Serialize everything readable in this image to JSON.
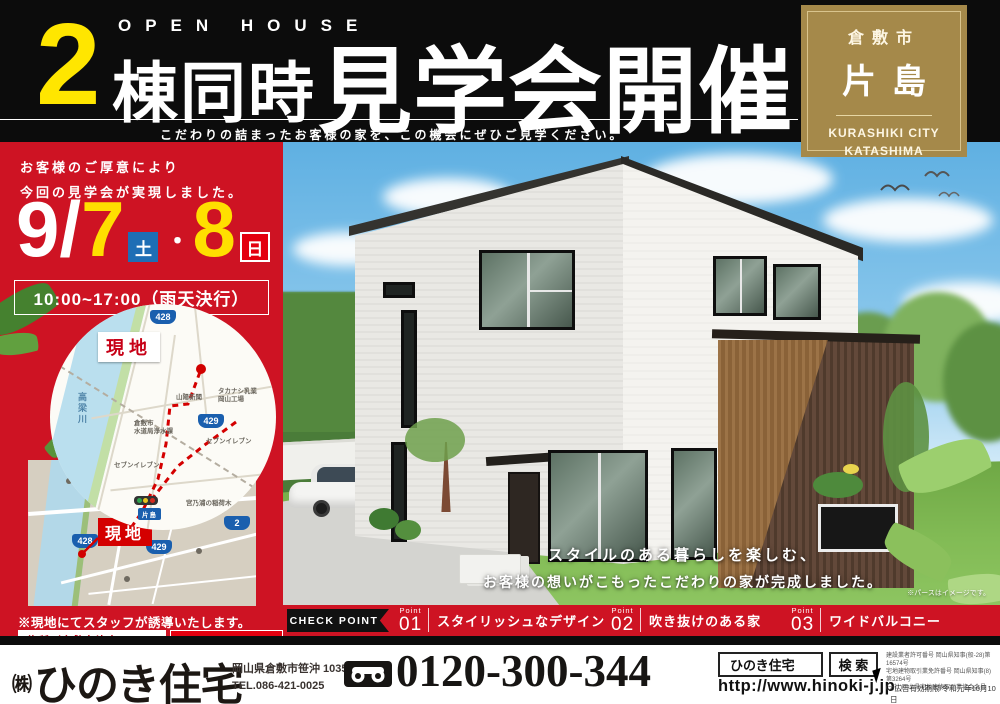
{
  "colors": {
    "accent_red": "#ce1323",
    "badge_brown": "#a5894a",
    "highlight_yellow": "#ffe600",
    "header_black": "#0c0c0c",
    "shield_blue": "#1a5fae"
  },
  "header": {
    "num": "2",
    "open_house": "OPEN HOUSE",
    "title_bold": "棟同時",
    "title_big": "見学会開催",
    "tagline": "こだわりの詰まったお客様の家を、この機会にぜひご見学ください。"
  },
  "location_badge": {
    "city": "倉敷市",
    "area": "片島",
    "city_en": "KURASHIKI CITY",
    "area_en": "KATASHIMA"
  },
  "sidebar": {
    "intro1": "お客様のご厚意により",
    "intro2": "今回の見学会が実現しました。",
    "date_main": "9/",
    "date_day1": "7",
    "date_w1": "土",
    "date_sep": "・",
    "date_day2": "8",
    "date_w2": "日",
    "time": "10:00~17:00（雨天決行）",
    "staff_note": "※現地にてスタッフが誘導いたします。",
    "address": "住所／倉敷市片島町905-16付近",
    "call_note": "迷ったらお電話下さい。"
  },
  "map_circle": {
    "genchi": "現地",
    "river": "高梁川",
    "r428": "428",
    "r429": "429",
    "lbl_sanyo": "山陽新聞",
    "lbl_takanashi1": "タカナシ乳業",
    "lbl_takanashi2": "岡山工場",
    "lbl_suido1": "倉敷市",
    "lbl_suido2": "水道局浄水課",
    "lbl_seven1": "セブンイレブン",
    "lbl_seven2": "セブンイレブン",
    "lbl_miyanoura": "宮乃浦の稲荷木",
    "lbl_school1": "倉敷市立",
    "lbl_school2": "連島北小学校",
    "lbl_katashima": "片島"
  },
  "map_square": {
    "genchi": "現地",
    "r2": "2",
    "r428": "428",
    "r429": "429"
  },
  "scene": {
    "caption1": "スタイルのある暮らしを楽しむ、",
    "caption2": "お客様の想いがこもったこだわりの家が完成しました。",
    "disclaimer": "※パースはイメージです。"
  },
  "checkpoints": {
    "ribbon": "CHECK POINT",
    "items": [
      {
        "point": "Point",
        "num": "01",
        "label": "スタイリッシュなデザイン"
      },
      {
        "point": "Point",
        "num": "02",
        "label": "吹き抜けのある家"
      },
      {
        "point": "Point",
        "num": "03",
        "label": "ワイドバルコニー"
      }
    ]
  },
  "footer": {
    "company_mark": "㈱",
    "company": "ひのき住宅",
    "address": "岡山県倉敷市笹沖 1035-1",
    "tel": "TEL.086-421-0025",
    "freedial": "0120-300-344",
    "search_term": "ひのき住宅",
    "search_btn": "検 索",
    "url": "http://www.hinoki-j.jp",
    "legal1": "建設業者許可番号 岡山県知事(般-28)第16574号",
    "legal2": "宅地建物取引業免許番号 岡山県知事(8)第3264号",
    "legal3": "(一社)岡山県宅地建物取引業協会会員",
    "validity": "○広告有効期限/令和元年10月10日"
  }
}
